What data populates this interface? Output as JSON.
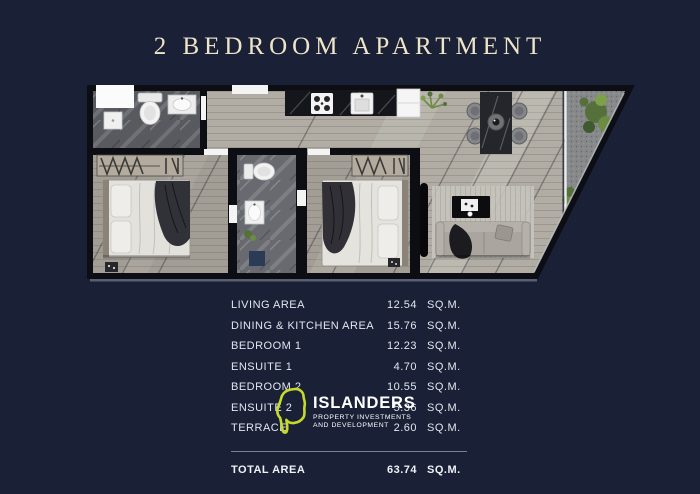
{
  "title": "2 BEDROOM APARTMENT",
  "areas": {
    "rows": [
      {
        "label": "LIVING AREA",
        "value": "12.54",
        "unit": "SQ.M."
      },
      {
        "label": "DINING & KITCHEN AREA",
        "value": "15.76",
        "unit": "SQ.M."
      },
      {
        "label": "BEDROOM 1",
        "value": "12.23",
        "unit": "SQ.M."
      },
      {
        "label": "ENSUITE 1",
        "value": "4.70",
        "unit": "SQ.M."
      },
      {
        "label": "BEDROOM 2",
        "value": "10.55",
        "unit": "SQ.M."
      },
      {
        "label": "ENSUITE 2",
        "value": "5.36",
        "unit": "SQ.M."
      },
      {
        "label": "TERRACE",
        "value": "2.60",
        "unit": "SQ.M."
      }
    ],
    "total": {
      "label": "TOTAL AREA",
      "value": "63.74",
      "unit": "SQ.M."
    }
  },
  "logo": {
    "name": "ISLANDERS",
    "tagline_line1": "PROPERTY INVESTMENTS",
    "tagline_line2": "AND DEVELOPMENT",
    "icon": "island-outline-icon",
    "icon_color": "#c6da2b"
  },
  "colors": {
    "background": "#1a2137",
    "title_text": "#eee4c9",
    "table_text": "#e2e6ee",
    "divider": "#8b90a0",
    "logo_green": "#c6da2b",
    "floor_open": "#b1ada4",
    "floor_bedroom": "#a29e95",
    "floor_bathroom": "#585a5f",
    "floor_terrace": "#86888a",
    "walls": "#0d0e13"
  }
}
